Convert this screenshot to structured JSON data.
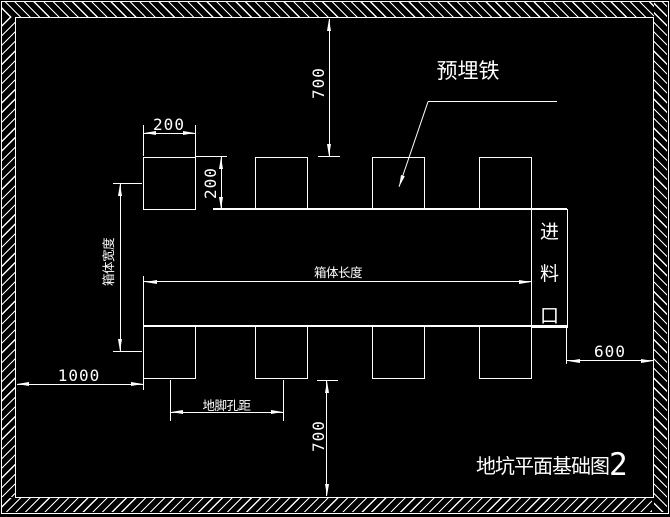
{
  "app": {
    "background_color": "#000000",
    "line_color": "#ffffff"
  },
  "title": {
    "text": "地坑平面基础图",
    "number": "2"
  },
  "leader": {
    "label": "预埋铁"
  },
  "feed_port": {
    "label": "进料口",
    "chars": [
      "进",
      "料",
      "口"
    ]
  },
  "dimensions": {
    "pad_width": "200",
    "pad_height": "200",
    "top_offset": "700",
    "bottom_offset": "700",
    "left_offset": "1000",
    "right_offset": "600",
    "box_length": "箱体长度",
    "box_width": "箱体宽度",
    "anchor_hole_spacing": "地脚孔距"
  }
}
